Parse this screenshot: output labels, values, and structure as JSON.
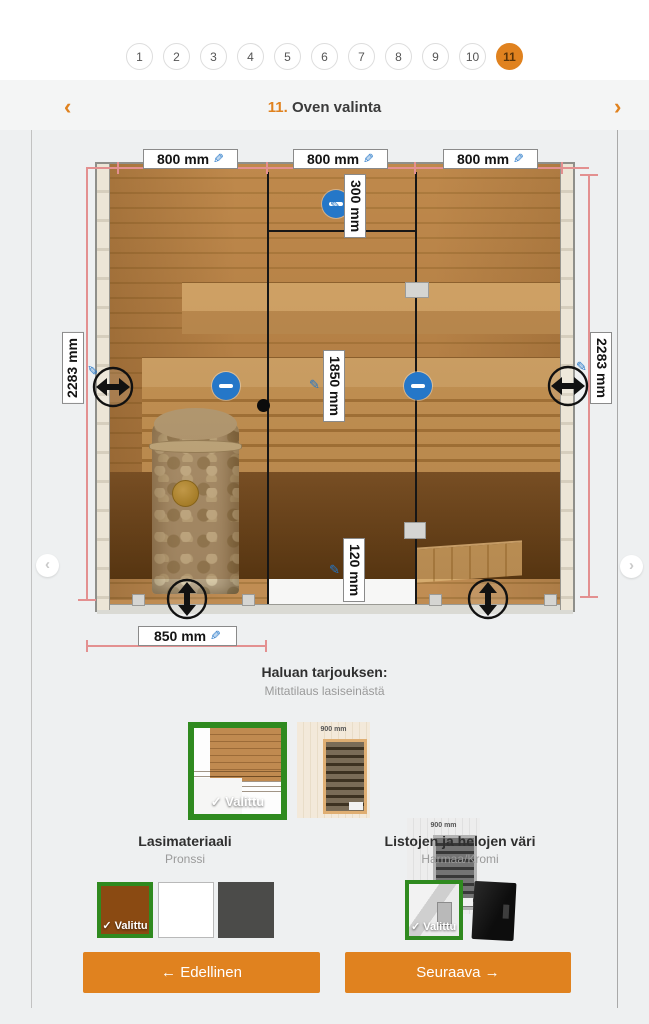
{
  "steps": {
    "items": [
      "1",
      "2",
      "3",
      "4",
      "5",
      "6",
      "7",
      "8",
      "9",
      "10",
      "11"
    ],
    "active": "11"
  },
  "header": {
    "prev_icon": "‹",
    "next_icon": "›",
    "number": "11.",
    "title": "Oven valinta"
  },
  "diagram": {
    "edit_icon": "✎",
    "width_left": "800 mm",
    "width_center": "800 mm",
    "width_right": "800 mm",
    "height_left": "2283 mm",
    "height_right": "2283 mm",
    "transom_height": "300 mm",
    "door_height": "1850 mm",
    "bottom_gap": "120 mm",
    "bottom_width": "850 mm",
    "carousel_prev_icon": "‹",
    "carousel_next_icon": "›"
  },
  "offer": {
    "title": "Haluan tarjouksen:",
    "subtitle": "Mittatilaus lasiseinästä"
  },
  "thumbnails": {
    "selected_badge": "✓ Valittu",
    "door_width_label": "900 mm"
  },
  "glass_section": {
    "title": "Lasimateriaali",
    "value": "Pronssi",
    "selected_badge": "✓ Valittu",
    "colors": {
      "bronze": "#8a4a12",
      "clear": "#ffffff",
      "dark_gray": "#4b4b49"
    }
  },
  "trim_section": {
    "title": "Listojen ja helojen väri",
    "value": "Harmaa/Kromi",
    "selected_badge": "✓ Valittu"
  },
  "buttons": {
    "previous": "← Edellinen",
    "next": "Seuraava →"
  },
  "colors": {
    "accent_orange": "#e0821f",
    "select_green": "#2f8a1f",
    "icon_blue": "#2577c8",
    "measure_red": "#e39090"
  }
}
